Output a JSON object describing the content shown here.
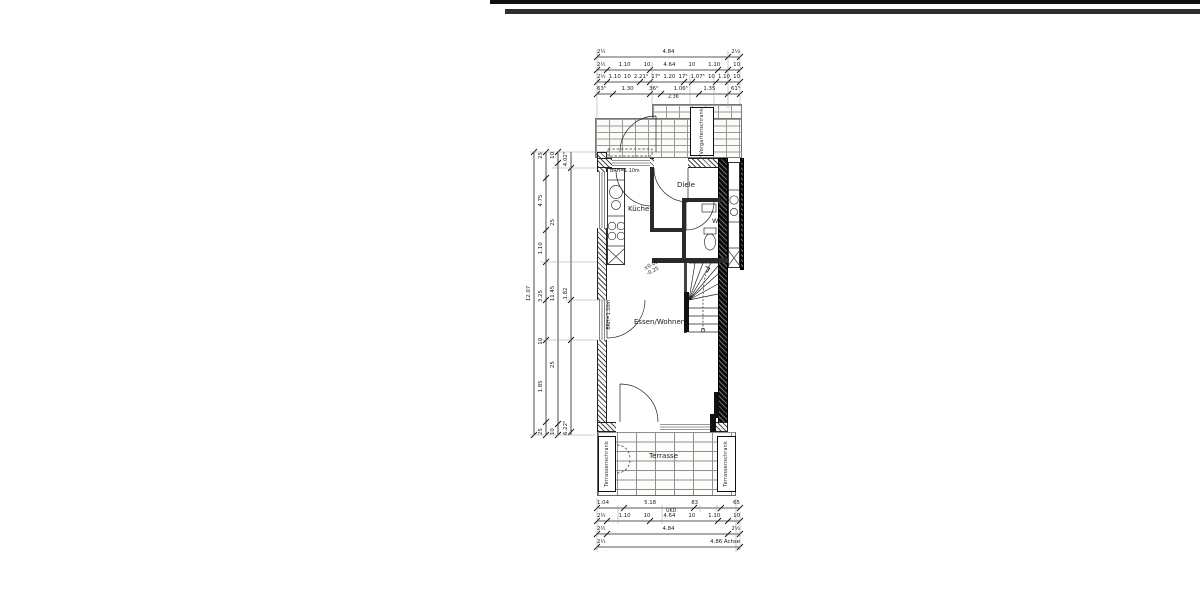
{
  "colors": {
    "paper": "#ffffff",
    "ink": "#1a1a1a"
  },
  "plan": {
    "rooms": {
      "kitchen": "Küche",
      "hall": "Diele",
      "wc": "WC",
      "living": "Essen/Wohnen",
      "terrace": "Terrasse"
    },
    "closets": {
      "front": "Vorgartenschrank",
      "terrace_left": "Terrassenschrank",
      "terrace_right": "Terrassenschrank"
    },
    "annotations": {
      "kitchen_window": "BRH=1.10m",
      "living_window": "BRH=1.10m",
      "level_upper": "±0.00",
      "level_lower": "-0.25"
    }
  },
  "dimensions": {
    "top_rows": [
      [
        "2½",
        "4.84",
        "2½"
      ],
      [
        "2½",
        "1.10",
        "10",
        "4.64",
        "10",
        "1.10",
        "10"
      ],
      [
        "2½",
        "1.10",
        "10",
        "2.21⁵",
        "17⁵",
        "1.20",
        "17⁵",
        "1.07⁵",
        "10",
        "1.10",
        "10"
      ],
      [
        "63⁵",
        "1.30",
        "36⁵",
        "1.06⁵",
        "1.35",
        "61⁵"
      ]
    ],
    "top_sub": "2.36",
    "left_cols": [
      [
        "12.07"
      ],
      [
        "25",
        "1.85",
        "10",
        "3.25",
        "1.10",
        "4.75",
        "25"
      ],
      [
        "10",
        "25",
        "11.45",
        "25",
        "10"
      ],
      [
        "6.22⁵",
        "1.82",
        "4.02⁵"
      ]
    ],
    "bottom_rows": [
      [
        "1.04",
        "5.18",
        "83",
        "65"
      ],
      [
        "2½",
        "1.10",
        "10",
        "4.64",
        "10",
        "1.10",
        "10"
      ],
      [
        "2½",
        "4.84",
        "2½"
      ],
      [
        "2½",
        "4.86 Achse"
      ]
    ],
    "bottom_sub": "UKD"
  }
}
